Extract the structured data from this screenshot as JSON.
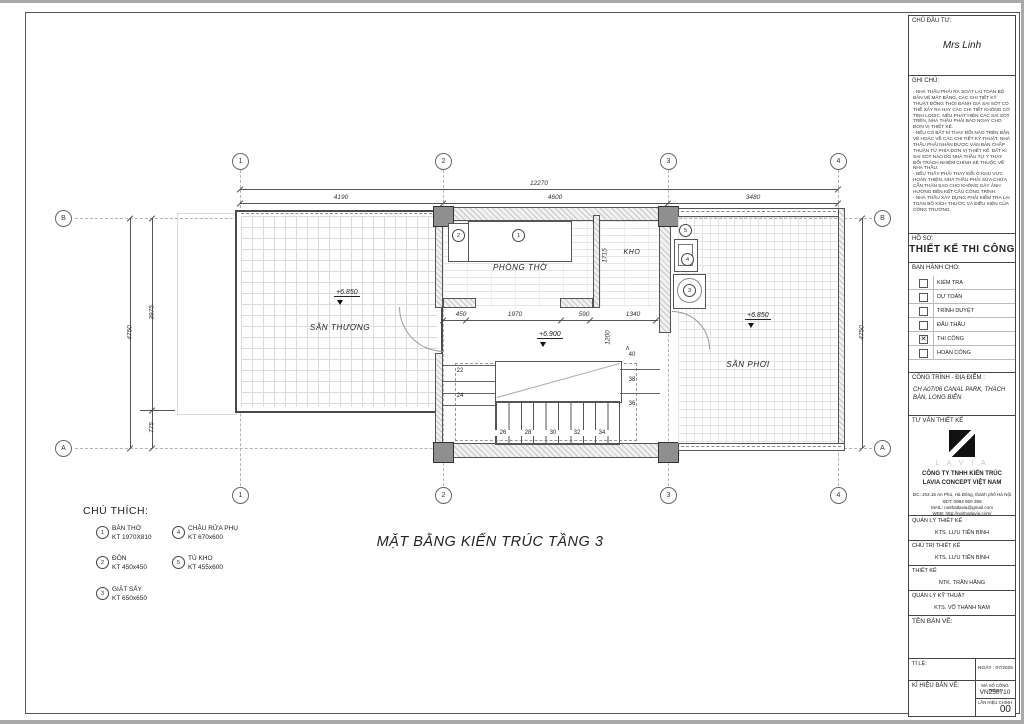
{
  "plan": {
    "title": "MẶT BẰNG KIẾN TRÚC TẦNG 3",
    "grid_cols": [
      "1",
      "2",
      "3",
      "4"
    ],
    "grid_rows": [
      "B",
      "A"
    ],
    "rooms": {
      "san_thuong": "SÂN THƯỢNG",
      "phong_tho": "PHÒNG THỜ",
      "kho": "KHO",
      "san_phoi": "SÂN PHƠI"
    },
    "levels": {
      "san_thuong": "+6.850",
      "san_phoi": "+6.850",
      "stair": "+6.900"
    },
    "dims": {
      "overall_w": "12270",
      "w1": "4190",
      "w2": "4600",
      "w3": "3480",
      "overall_h": "4750",
      "h1": "3975",
      "h2": "775",
      "right_h": "4750",
      "d450": "450",
      "d1970": "1970",
      "d590": "590",
      "d1340": "1340",
      "d1715": "1715",
      "d1200": "1200"
    },
    "stair_numbers": [
      "22",
      "24",
      "26",
      "28",
      "30",
      "32",
      "34",
      "36",
      "38",
      "40"
    ]
  },
  "legend": {
    "title": "CHÚ THÍCH:",
    "items": [
      {
        "num": "1",
        "name": "BÀN THỜ",
        "size": "KT 1970X810"
      },
      {
        "num": "2",
        "name": "ĐÔN",
        "size": "KT 450x450"
      },
      {
        "num": "3",
        "name": "GIẶT SẤY",
        "size": "KT 650x650"
      },
      {
        "num": "4",
        "name": "CHẬU RỬA PHỤ",
        "size": "KT 670x600"
      },
      {
        "num": "5",
        "name": "TỦ KHO",
        "size": "KT 455x600"
      }
    ]
  },
  "title_block": {
    "client_label": "CHỦ ĐẦU TƯ:",
    "client_name": "Mrs Linh",
    "notes_label": "GHI CHÚ:",
    "notes": [
      "- NHÀ THẦU PHẢI RÀ SOÁT LẠI TOÀN BỘ BẢN VẼ MẶT BẰNG, CÁC CHI TIẾT KỸ THUẬT ĐỒNG THỜI ĐÁNH GIÁ SAI SÓT CÓ THỂ XẢY RA HAY CÁC CHI TIẾT KHÔNG CÓ TÍNH LOGIC. NẾU PHÁT HIỆN CÁC SAI SÓT TRÊN, NHÀ THẦU PHẢI BÁO NGAY CHO ĐƠN VỊ THIẾT KẾ.",
      "- NẾU CÓ BẤT KÌ THAY ĐỔI NÀO TRÊN BẢN VẼ HOẶC VỀ CÁC CHI TIẾT KỸ THUẬT, NHÀ THẦU PHẢI NHẬN ĐƯỢC VĂN BẢN CHẤP THUẬN TỪ PHÍA ĐƠN VỊ THIẾT KẾ. BẤT KÌ SAI SÓT NÀO DO NHÀ THẦU TỰ Ý THAY ĐỔI TRÁCH NHIỆM CHÍNH SẼ THUỘC VỀ NHÀ THẦU.",
      "- NẾU THẤY PHẢI THAY ĐỔI Ở KHU VỰC HOÀN THIỆN, NHÀ THẦU PHẢI SỬA CHỮA CẨN THẬN SAO CHO KHÔNG GÂY ẢNH HƯỞNG ĐẾN KẾT CẤU CÔNG TRÌNH.",
      "- NHÀ THẦU XÂY DỰNG PHẢI KIỂM TRA LẠI TOÀN BỘ KÍCH THƯỚC VÀ ĐIỀU KIỆN CỦA CÔNG TRƯỜNG."
    ],
    "dossier_label": "HỒ SƠ:",
    "dossier_title": "THIẾT KẾ THI CÔNG",
    "issued_label": "BAN HÀNH CHO:",
    "issued": [
      {
        "label": "KIỂM TRA",
        "checked": false
      },
      {
        "label": "DỰ TOÁN",
        "checked": false
      },
      {
        "label": "TRÌNH DUYỆT",
        "checked": false
      },
      {
        "label": "ĐẤU THẦU",
        "checked": false
      },
      {
        "label": "THI CÔNG",
        "checked": true
      },
      {
        "label": "HOÀN CÔNG",
        "checked": false
      }
    ],
    "project_label": "CÔNG TRÌNH - ĐỊA ĐIỂM :",
    "project_location": "CH A07/06 CANAL PARK, THẠCH BÀN, LONG BIÊN",
    "consultant_label": "TƯ VẤN THIẾT KẾ",
    "logo_text": "L A V I A",
    "company_line1": "CÔNG TY TNHH KIẾN TRÚC",
    "company_line2": "LAVIA CONCEPT VIỆT NAM",
    "address": "ĐC: J03.15 An Phú, Hà Đông, thành phố Hà Nội",
    "phone": "SĐT: 0984 900 396",
    "mail": "MAIL: noithatlavia@gmail.com",
    "web": "WEB: http://noithatlavia.com/",
    "roles": [
      {
        "label": "QUẢN LÝ THIẾT KẾ",
        "name": "KTS. LƯU TIẾN BÌNH"
      },
      {
        "label": "CHỦ TRÌ THIẾT KẾ",
        "name": "KTS. LƯU TIẾN BÌNH"
      },
      {
        "label": "THIẾT KẾ",
        "name": "NTK. TRẦN HẰNG"
      },
      {
        "label": "QUẢN LÝ KỸ THUẬT",
        "name": "KTS. VÕ THÀNH NAM"
      }
    ],
    "drawing_name_label": "TÊN BẢN VẼ:",
    "scale_label": "TỈ LỆ:",
    "date_label": "NGÀY :",
    "date_value": "07/2025",
    "sheet_code_label": "KÍ HIỆU BẢN VẼ:",
    "project_code_label": "MÃ SỐ CÔNG TRÌNH",
    "project_code": "VN250710",
    "revision_label": "LẦN HIỆU CHỈNH",
    "revision": "00"
  }
}
